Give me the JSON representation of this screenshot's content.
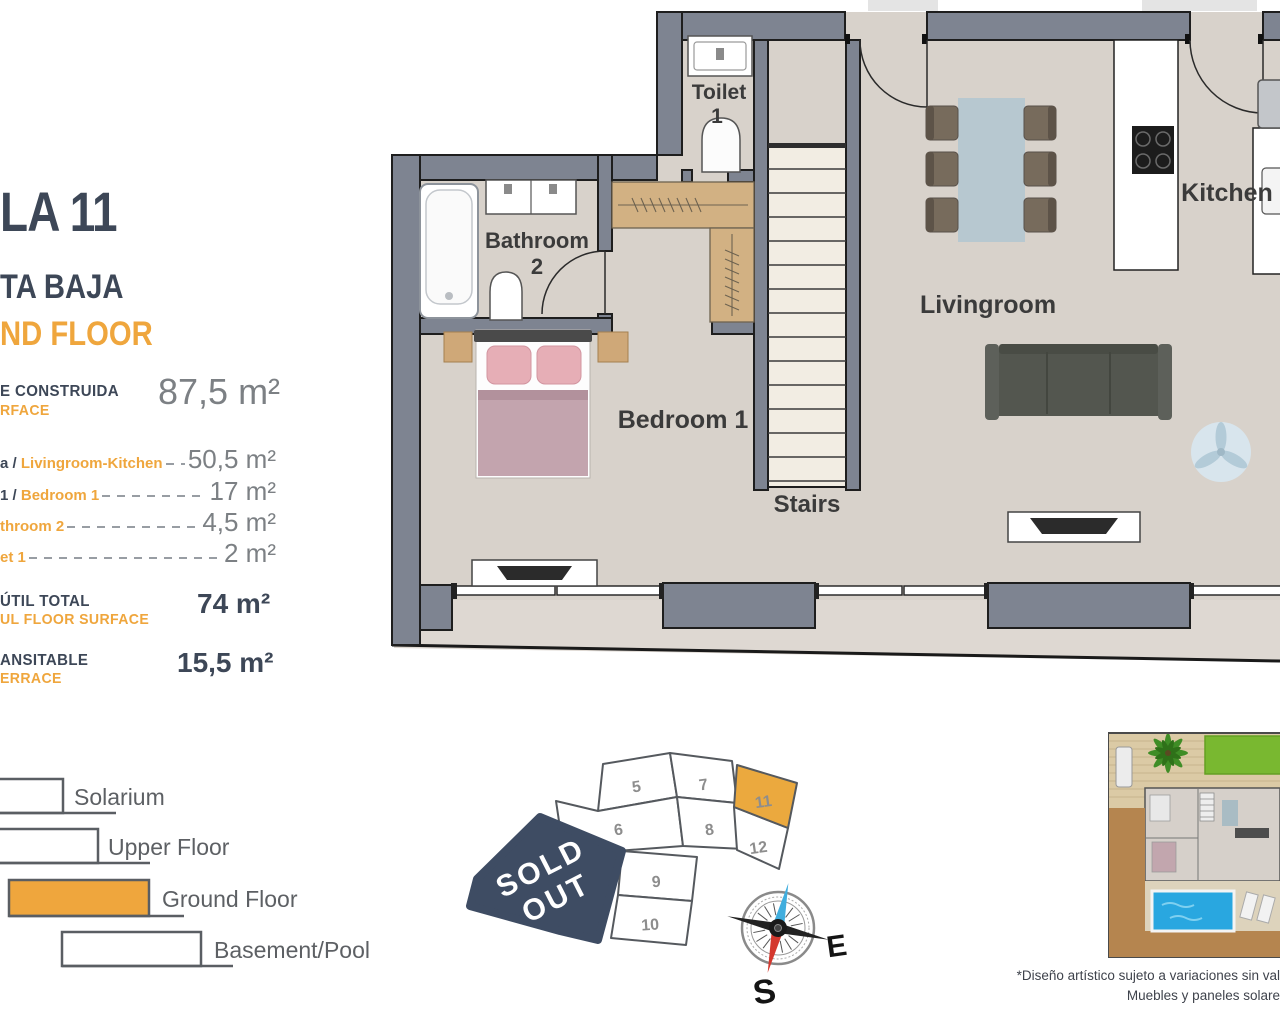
{
  "panel": {
    "title": "LA 11",
    "subtitle_es": "TA BAJA",
    "subtitle_en": "ND FLOOR",
    "built_label_es": "E CONSTRUIDA",
    "built_label_en": "RFACE",
    "built_value": "87,5 m²",
    "rows": [
      {
        "prefix": "a / ",
        "label": "Livingroom-Kitchen",
        "value": "50,5 m²"
      },
      {
        "prefix": "1 / ",
        "label": "Bedroom 1",
        "value": "17 m²"
      },
      {
        "prefix": "",
        "label": "throom 2",
        "value": "4,5 m²"
      },
      {
        "prefix": "",
        "label": "et 1",
        "value": "2 m²"
      }
    ],
    "useful_label_es": "ÚTIL TOTAL",
    "useful_label_en": "UL FLOOR SURFACE",
    "useful_value": "74 m²",
    "terrace_label_es": "ANSITABLE",
    "terrace_label_en": "ERRACE",
    "terrace_value": "15,5 m²"
  },
  "rooms": {
    "toilet_line1": "Toilet",
    "toilet_line2": "1",
    "bathroom_line1": "Bathroom",
    "bathroom_line2": "2",
    "bedroom": "Bedroom 1",
    "stairs": "Stairs",
    "livingroom": "Livingroom",
    "kitchen": "Kitchen"
  },
  "legend": {
    "items": [
      {
        "label": "Solarium",
        "highlighted": false
      },
      {
        "label": "Upper Floor",
        "highlighted": false
      },
      {
        "label": "Ground Floor",
        "highlighted": true
      },
      {
        "label": "Basement/Pool",
        "highlighted": false
      }
    ]
  },
  "siteplan": {
    "sold_out_line1": "SOLD",
    "sold_out_line2": "OUT",
    "highlighted_plot": "11",
    "plots": {
      "p5": "5",
      "p6": "6",
      "p7": "7",
      "p8": "8",
      "p9": "9",
      "p10": "10",
      "p11": "11",
      "p12": "12"
    }
  },
  "compass": {
    "east": "E",
    "south": "S"
  },
  "disclaimer": {
    "line1": "*Diseño artístico sujeto a variaciones sin val",
    "line2": "Muebles y paneles solare"
  },
  "colors": {
    "navy": "#3d4757",
    "orange": "#efa63d",
    "value_gray": "#7c8084",
    "wall_gray": "#7e8491",
    "floor_beige": "#d8d2cb",
    "terrace_beige": "#ded8d2",
    "soldout_navy": "#3e4c63",
    "pool_blue": "#29a7e0",
    "lawn_green": "#79b830"
  }
}
